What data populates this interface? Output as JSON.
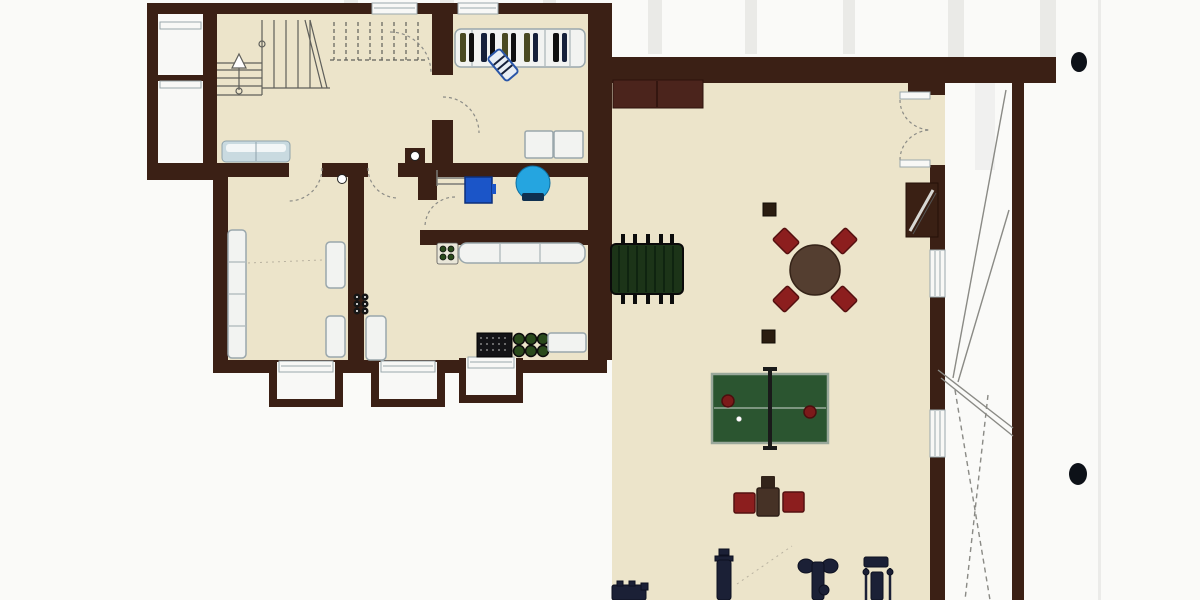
{
  "palette": {
    "paper": "#fafaf8",
    "scan_streak": "#e6e6e3",
    "wall": "#3b2015",
    "floor": "#ece4ca",
    "white": "#f8f8f6",
    "outline_gray": "#9aa7ac",
    "stair_line": "#5f5f5a",
    "door_line": "#8b8b86",
    "counter_blue": "#c9dae0",
    "cabinet_fill": "#f2f3f1",
    "furnace_blue": "#1b55c8",
    "tank_blue": "#25a5e0",
    "tank_dark": "#0f3050",
    "foosball_green": "#1c3418",
    "pingpong_green": "#2b5530",
    "pingpong_border": "#9aa89b",
    "paddle_red": "#7c1a1a",
    "table_brown": "#543e30",
    "chair_red": "#8c1e1e",
    "chair_brown": "#463226",
    "bar_maroon": "#4b241c",
    "equipment_navy": "#1b2036",
    "bottle_green": "#2a4a1c",
    "crate_black": "#141417",
    "fireplace_brown": "#3a2014",
    "column_brown": "#2a1c10",
    "hole_punch": "#0d1118",
    "clothes_olive": "#4a4a22",
    "clothes_navy": "#16203a",
    "clothes_black": "#101010",
    "board_blue": "#2a56a8"
  },
  "legend": {
    "drawing": "scanned basement floor plan, no text labels visible",
    "symbols": [
      "staircase-with-up-arrow",
      "wardrobe-with-hanging-clothes",
      "washer-dryer-squares",
      "furnace-and-water-tank",
      "kitchen-counter-and-bottle-rack",
      "storage-crate-and-jugs",
      "foosball-table",
      "round-table-with-four-chairs",
      "ping-pong-table-with-paddles",
      "three-chairs",
      "exercise-equipment-row",
      "double-door-to-exterior-stair",
      "window-wells",
      "hole-punch-marks"
    ]
  }
}
